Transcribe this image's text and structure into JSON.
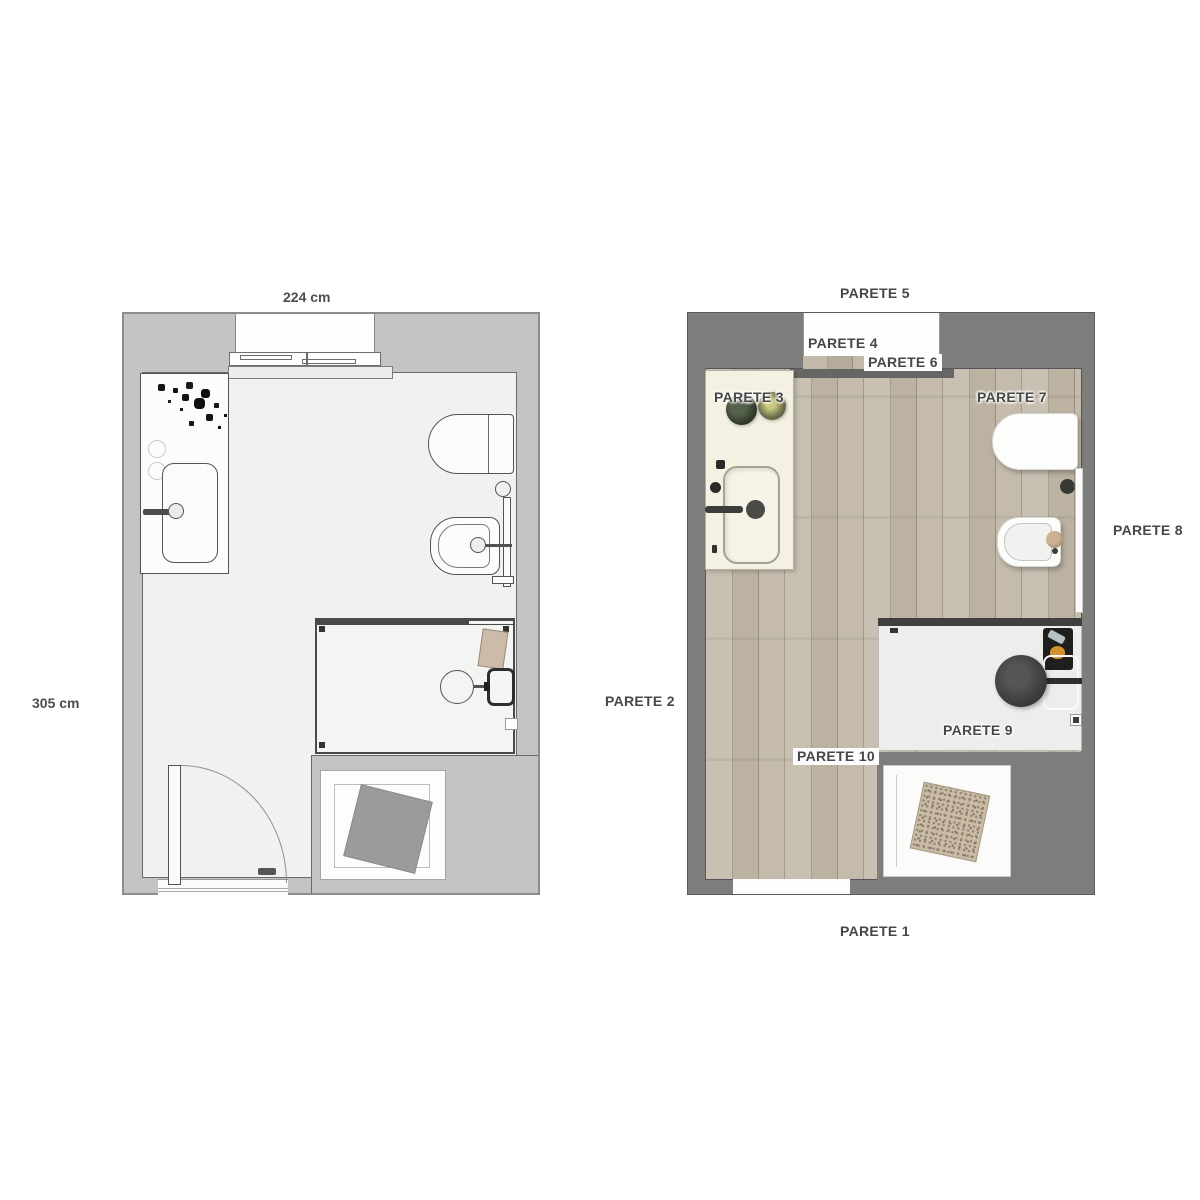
{
  "left_plan": {
    "name": "technical bathroom floor plan",
    "dimensions": {
      "width": "224 cm",
      "height": "305 cm"
    },
    "fixtures": [
      "window",
      "vanity",
      "plant",
      "sink",
      "faucet",
      "toilet",
      "grab-rail",
      "bidet",
      "shower-enclosure",
      "shower-stool",
      "shower-shelf",
      "towel",
      "shower-tray",
      "rug",
      "door",
      "door-swing-arc"
    ]
  },
  "right_plan": {
    "name": "rendered bathroom floor plan",
    "labels": {
      "p1": "PARETE 1",
      "p2": "PARETE 2",
      "p3": "PARETE 3",
      "p4": "PARETE 4",
      "p5": "PARETE 5",
      "p6": "PARETE 6",
      "p7": "PARETE 7",
      "p8": "PARETE 8",
      "p9": "PARETE 9",
      "p10": "PARETE 10"
    },
    "fixtures": [
      "window",
      "vanity",
      "plants",
      "sink",
      "faucet",
      "toilet",
      "valve-knob",
      "wall-rail",
      "bidet",
      "shower-floor",
      "shower-stool",
      "shower-shelf",
      "soap-items",
      "shower-tray",
      "bath-mat",
      "door-opening"
    ]
  },
  "colors": {
    "wall_light": "#c4c4c3",
    "room_light": "#f1f1f0",
    "wall_dark": "#7d7d7b",
    "wood_light": "#c8c0b1",
    "wood_dark": "#9a9080",
    "counter_cream": "#f4f1e2",
    "label_text": "#474747",
    "fixture_outline": "#535353"
  }
}
